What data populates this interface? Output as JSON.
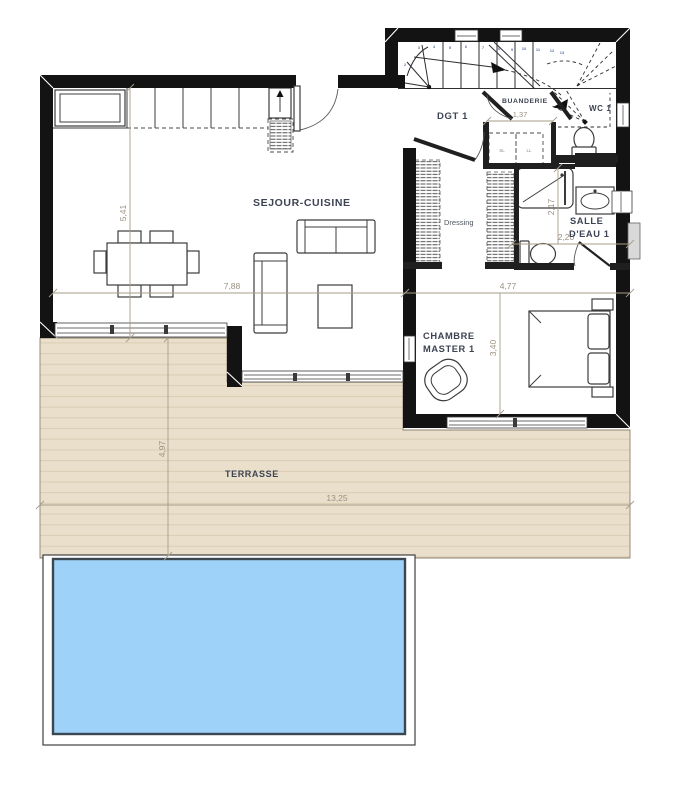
{
  "plan": {
    "rooms": {
      "sejour_cuisine": "SEJOUR-CUISINE",
      "dgt": "DGT 1",
      "buanderie": "BUANDERIE",
      "wc": "WC 1",
      "salle_eau": [
        "SALLE",
        "D'EAU 1"
      ],
      "dressing": "Dressing",
      "chambre": [
        "CHAMBRE",
        "MASTER 1"
      ],
      "terrasse": "TERRASSE"
    },
    "appliances": {
      "sl": "SL",
      "ll": "LL"
    },
    "dimensions": {
      "sejour_height": "5,41",
      "sejour_width": "7,88",
      "buanderie_width": "1,37",
      "salle_eau_height": "2,17",
      "salle_eau_width": "2,20",
      "chambre_width": "4,77",
      "chambre_height": "3,40",
      "terrasse_height": "4,97",
      "terrasse_width": "13,25"
    },
    "stairs": {
      "numbers": [
        "1",
        "2",
        "3",
        "4",
        "5",
        "6",
        "7",
        "8",
        "9",
        "10",
        "11",
        "12",
        "13"
      ]
    },
    "colors": {
      "wall": "#131313",
      "terrace": "#eadfcb",
      "terrace_line": "#d9cdb3",
      "pool_water": "#9ed2f9",
      "pool_border": "#3a4750",
      "dimension_text": "#9a9080",
      "label_text": "#3c4352",
      "stair_number": "#5d74a8"
    }
  }
}
